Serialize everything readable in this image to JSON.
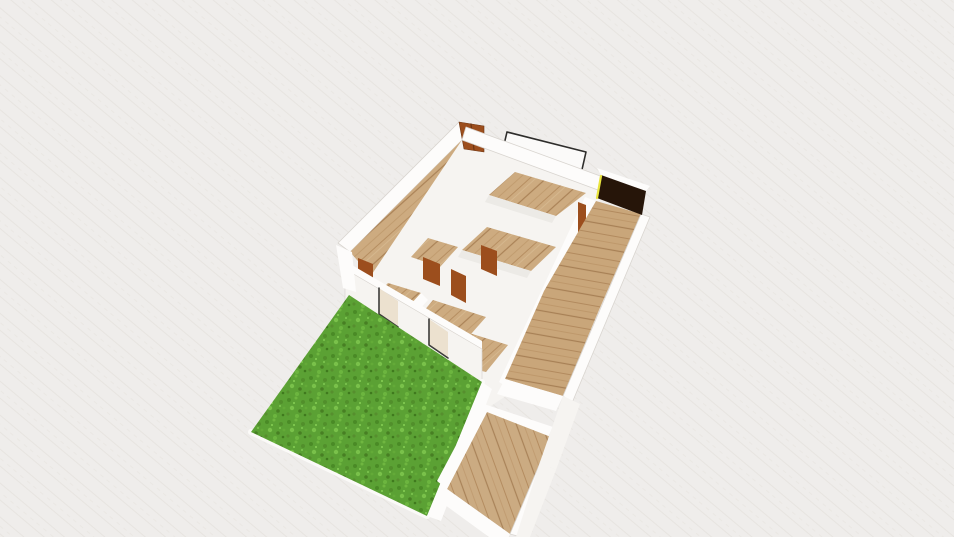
{
  "app": {
    "name": "3D floor plan viewport",
    "view_mode": "3D orbit view",
    "visible_text": []
  },
  "palette": {
    "bg": "#efedeb",
    "bgLine": "#e6e3df",
    "wallTop": "#fdfcfb",
    "wallFace": "#f6f4f1",
    "wallShade": "#eceae6",
    "edge": "#d9d5d0",
    "woodBase": "#cdab80",
    "woodDark": "#aa8257",
    "grassBase": "#5ba134",
    "grassDark": "#4a8a26",
    "grassLight": "#79c14a",
    "door": "#9c4e1d",
    "doorDark": "#6e3512",
    "darkRoom": "#261509",
    "accentYellow": "#e9e43e",
    "frame": "#2e2d2b",
    "windowPane": "#ece1cf",
    "windowShadow": "#3c3c3a",
    "curb": "#fbfaf8"
  },
  "canvas": {
    "width": 954,
    "height": 537
  },
  "scene": {
    "elements": [
      {
        "name": "ground-plane",
        "kind": "poly",
        "fill": "@bg",
        "points": [
          [
            0,
            0
          ],
          [
            954,
            0
          ],
          [
            954,
            537
          ],
          [
            0,
            537
          ]
        ]
      },
      {
        "name": "ground-plane-texture",
        "kind": "poly",
        "fill": "tex:bgTex",
        "points": [
          [
            0,
            0
          ],
          [
            954,
            0
          ],
          [
            954,
            537
          ],
          [
            0,
            537
          ]
        ]
      },
      {
        "name": "flat-window-frame",
        "kind": "poly",
        "fill": "#fbfaf9",
        "stroke": "@frame",
        "sw": 1.6,
        "points": [
          [
            507,
            132
          ],
          [
            586,
            152
          ],
          [
            581,
            174
          ],
          [
            502,
            153
          ]
        ]
      },
      {
        "name": "leftwing-outer-wall-top",
        "kind": "poly",
        "fill": "@wallTop",
        "stroke": "@edge",
        "sw": 0.8,
        "points": [
          [
            338,
            243
          ],
          [
            459,
            122
          ],
          [
            471,
            131
          ],
          [
            350,
            252
          ]
        ]
      },
      {
        "name": "leftwing-corridor-floor",
        "kind": "poly",
        "fill": "tex:woodA",
        "points": [
          [
            350,
            252
          ],
          [
            471,
            131
          ],
          [
            492,
            153
          ],
          [
            371,
            276
          ]
        ]
      },
      {
        "name": "leftwing-inner-wall-top",
        "kind": "poly",
        "fill": "@wallTop",
        "points": [
          [
            371,
            276
          ],
          [
            492,
            153
          ],
          [
            501,
            162
          ],
          [
            380,
            285
          ]
        ]
      },
      {
        "name": "midblock-wall-base",
        "kind": "poly",
        "fill": "@wallFace",
        "points": [
          [
            368,
            280
          ],
          [
            466,
            134
          ],
          [
            604,
            188
          ],
          [
            560,
            300
          ],
          [
            512,
            392
          ],
          [
            462,
            425
          ],
          [
            398,
            330
          ]
        ]
      },
      {
        "name": "entry-door",
        "kind": "poly",
        "fill": "@door",
        "stroke": "@doorDark",
        "sw": 0.6,
        "points": [
          [
            459,
            122
          ],
          [
            484,
            126
          ],
          [
            484,
            152
          ],
          [
            464,
            149
          ]
        ]
      },
      {
        "name": "entry-door-seam",
        "kind": "line",
        "stroke": "@doorDark",
        "sw": 1.2,
        "points": [
          [
            471,
            124
          ],
          [
            474,
            150
          ]
        ]
      },
      {
        "name": "topright-wall-top",
        "kind": "poly",
        "fill": "@wallTop",
        "stroke": "@edge",
        "sw": 0.8,
        "points": [
          [
            466,
            127
          ],
          [
            603,
            177
          ],
          [
            598,
            190
          ],
          [
            462,
            140
          ]
        ]
      },
      {
        "name": "room1-floor",
        "kind": "poly",
        "fill": "tex:woodA",
        "points": [
          [
            515,
            172
          ],
          [
            586,
            193
          ],
          [
            556,
            216
          ],
          [
            489,
            195
          ]
        ]
      },
      {
        "name": "room1-wall-face",
        "kind": "poly",
        "fill": "@wallShade",
        "points": [
          [
            489,
            195
          ],
          [
            556,
            216
          ],
          [
            552,
            223
          ],
          [
            485,
            202
          ]
        ]
      },
      {
        "name": "room6-floor",
        "kind": "poly",
        "fill": "tex:woodA",
        "points": [
          [
            428,
            238
          ],
          [
            458,
            247
          ],
          [
            440,
            267
          ],
          [
            411,
            257
          ]
        ]
      },
      {
        "name": "room2-floor",
        "kind": "poly",
        "fill": "tex:woodA",
        "points": [
          [
            487,
            227
          ],
          [
            556,
            247
          ],
          [
            531,
            271
          ],
          [
            462,
            250
          ]
        ]
      },
      {
        "name": "room2-wall-face",
        "kind": "poly",
        "fill": "@wallShade",
        "points": [
          [
            462,
            250
          ],
          [
            531,
            271
          ],
          [
            527,
            278
          ],
          [
            458,
            257
          ]
        ]
      },
      {
        "name": "room3-floor",
        "kind": "poly",
        "fill": "tex:woodA",
        "points": [
          [
            388,
            283
          ],
          [
            421,
            293
          ],
          [
            401,
            315
          ],
          [
            368,
            304
          ]
        ]
      },
      {
        "name": "partition-wall-top",
        "kind": "poly",
        "fill": "@wallTop",
        "points": [
          [
            401,
            315
          ],
          [
            421,
            293
          ],
          [
            428,
            300
          ],
          [
            408,
            322
          ]
        ]
      },
      {
        "name": "room4-floor",
        "kind": "poly",
        "fill": "tex:woodA",
        "points": [
          [
            433,
            300
          ],
          [
            486,
            317
          ],
          [
            464,
            342
          ],
          [
            413,
            324
          ]
        ]
      },
      {
        "name": "room5-floor",
        "kind": "poly",
        "fill": "tex:woodA",
        "points": [
          [
            427,
            320
          ],
          [
            508,
            345
          ],
          [
            486,
            372
          ],
          [
            404,
            352
          ]
        ]
      },
      {
        "name": "interior-door-1",
        "kind": "poly",
        "fill": "@door",
        "points": [
          [
            358,
            258
          ],
          [
            373,
            264
          ],
          [
            373,
            284
          ],
          [
            358,
            277
          ]
        ]
      },
      {
        "name": "interior-door-2",
        "kind": "poly",
        "fill": "@door",
        "points": [
          [
            423,
            257
          ],
          [
            440,
            264
          ],
          [
            440,
            286
          ],
          [
            423,
            279
          ]
        ]
      },
      {
        "name": "interior-door-3",
        "kind": "poly",
        "fill": "@door",
        "points": [
          [
            451,
            269
          ],
          [
            466,
            276
          ],
          [
            466,
            303
          ],
          [
            451,
            295
          ]
        ]
      },
      {
        "name": "interior-door-4",
        "kind": "poly",
        "fill": "@door",
        "points": [
          [
            481,
            245
          ],
          [
            497,
            251
          ],
          [
            497,
            276
          ],
          [
            481,
            269
          ]
        ]
      },
      {
        "name": "corridor-left-wall-top",
        "kind": "poly",
        "fill": "@wallTop",
        "points": [
          [
            585,
            197
          ],
          [
            596,
            201
          ],
          [
            509,
            388
          ],
          [
            499,
            382
          ]
        ]
      },
      {
        "name": "corridor-wall-door",
        "kind": "poly",
        "fill": "@door",
        "points": [
          [
            578,
            202
          ],
          [
            586,
            205
          ],
          [
            586,
            240
          ],
          [
            578,
            236
          ]
        ]
      },
      {
        "name": "hallway-floor",
        "kind": "poly",
        "fill": "tex:woodB",
        "points": [
          [
            596,
            201
          ],
          [
            641,
            214
          ],
          [
            599,
            310
          ],
          [
            563,
            396
          ],
          [
            505,
            379
          ],
          [
            544,
            291
          ]
        ]
      },
      {
        "name": "corridor-right-wall-top",
        "kind": "poly",
        "fill": "@wallTop",
        "stroke": "@edge",
        "sw": 0.8,
        "points": [
          [
            641,
            214
          ],
          [
            650,
            217
          ],
          [
            572,
            403
          ],
          [
            563,
            396
          ]
        ]
      },
      {
        "name": "darkroom-back-wall-top",
        "kind": "poly",
        "fill": "@wallTop",
        "points": [
          [
            597,
            168
          ],
          [
            650,
            186
          ],
          [
            646,
            191
          ],
          [
            601,
            175
          ]
        ]
      },
      {
        "name": "darkroom-floor",
        "kind": "poly",
        "fill": "@darkRoom",
        "points": [
          [
            601,
            175
          ],
          [
            646,
            191
          ],
          [
            642,
            215
          ],
          [
            597,
            198
          ]
        ]
      },
      {
        "name": "darkroom-yellow-edge",
        "kind": "line",
        "stroke": "@accentYellow",
        "sw": 2.2,
        "points": [
          [
            601,
            176
          ],
          [
            597,
            198
          ]
        ]
      },
      {
        "name": "front-wall-top",
        "kind": "poly",
        "fill": "@wallTop",
        "points": [
          [
            345,
            261
          ],
          [
            482,
            341
          ],
          [
            482,
            349
          ],
          [
            345,
            269
          ]
        ]
      },
      {
        "name": "front-wall-face",
        "kind": "poly",
        "fill": "@wallFace",
        "stroke": "@edge",
        "sw": 0.7,
        "points": [
          [
            345,
            269
          ],
          [
            482,
            349
          ],
          [
            482,
            384
          ],
          [
            345,
            304
          ]
        ]
      },
      {
        "name": "front-window-1",
        "kind": "poly",
        "fill": "@windowPane",
        "points": [
          [
            379,
            288
          ],
          [
            398,
            301
          ],
          [
            398,
            327
          ],
          [
            379,
            314
          ]
        ]
      },
      {
        "name": "front-window-1-frame-shadow",
        "kind": "polyline",
        "stroke": "@windowShadow",
        "sw": 1.6,
        "points": [
          [
            379,
            288
          ],
          [
            379,
            314
          ],
          [
            398,
            327
          ]
        ]
      },
      {
        "name": "front-window-2",
        "kind": "poly",
        "fill": "@windowPane",
        "points": [
          [
            429,
            319
          ],
          [
            448,
            332
          ],
          [
            448,
            358
          ],
          [
            429,
            345
          ]
        ]
      },
      {
        "name": "front-window-2-frame-shadow",
        "kind": "polyline",
        "stroke": "@windowShadow",
        "sw": 1.6,
        "points": [
          [
            429,
            319
          ],
          [
            429,
            345
          ],
          [
            448,
            358
          ]
        ]
      },
      {
        "name": "leftwing-end-wall",
        "kind": "poly",
        "fill": "@wallTop",
        "points": [
          [
            336,
            245
          ],
          [
            352,
            252
          ],
          [
            356,
            292
          ],
          [
            343,
            288
          ]
        ]
      },
      {
        "name": "lawn-curb",
        "kind": "polyline",
        "stroke": "@curb",
        "sw": 6,
        "points": [
          [
            482,
            382
          ],
          [
            427,
            516
          ],
          [
            251,
            432
          ]
        ]
      },
      {
        "name": "grass-lawn",
        "kind": "poly",
        "fill": "tex:grassTex",
        "points": [
          [
            349,
            295
          ],
          [
            482,
            382
          ],
          [
            427,
            516
          ],
          [
            251,
            432
          ]
        ]
      },
      {
        "name": "lawn-side-wall-top",
        "kind": "poly",
        "fill": "@wallTop",
        "points": [
          [
            482,
            382
          ],
          [
            492,
            389
          ],
          [
            441,
            521
          ],
          [
            427,
            516
          ]
        ]
      },
      {
        "name": "hallway-end-wall-top",
        "kind": "poly",
        "fill": "@wallTop",
        "points": [
          [
            505,
            379
          ],
          [
            563,
            396
          ],
          [
            556,
            411
          ],
          [
            497,
            394
          ]
        ]
      },
      {
        "name": "bottomroom-top-wall",
        "kind": "poly",
        "fill": "@wallTop",
        "points": [
          [
            478,
            402
          ],
          [
            553,
            427
          ],
          [
            547,
            439
          ],
          [
            472,
            413
          ]
        ]
      },
      {
        "name": "bottomroom-floor",
        "kind": "poly",
        "fill": "tex:woodC",
        "points": [
          [
            487,
            412
          ],
          [
            551,
            437
          ],
          [
            510,
            534
          ],
          [
            447,
            489
          ]
        ]
      },
      {
        "name": "bottomroom-left-wall-top",
        "kind": "poly",
        "fill": "@wallTop",
        "points": [
          [
            478,
            404
          ],
          [
            487,
            412
          ],
          [
            447,
            489
          ],
          [
            437,
            481
          ]
        ]
      },
      {
        "name": "bottomroom-right-wall-top",
        "kind": "poly",
        "fill": "@wallTop",
        "stroke": "@edge",
        "sw": 0.8,
        "points": [
          [
            551,
            437
          ],
          [
            561,
            441
          ],
          [
            521,
            537
          ],
          [
            510,
            534
          ]
        ]
      },
      {
        "name": "bottomroom-bottom-wall-top",
        "kind": "poly",
        "fill": "@wallTop",
        "points": [
          [
            447,
            489
          ],
          [
            510,
            534
          ],
          [
            504,
            548
          ],
          [
            441,
            502
          ]
        ]
      },
      {
        "name": "right-lower-wall-face-a",
        "kind": "poly",
        "fill": "@wallFace",
        "points": [
          [
            563,
            396
          ],
          [
            580,
            404
          ],
          [
            556,
            470
          ],
          [
            540,
            462
          ]
        ]
      },
      {
        "name": "right-lower-wall-face-b",
        "kind": "poly",
        "fill": "@wallFace",
        "points": [
          [
            540,
            462
          ],
          [
            556,
            470
          ],
          [
            530,
            537
          ],
          [
            516,
            537
          ]
        ]
      }
    ]
  }
}
